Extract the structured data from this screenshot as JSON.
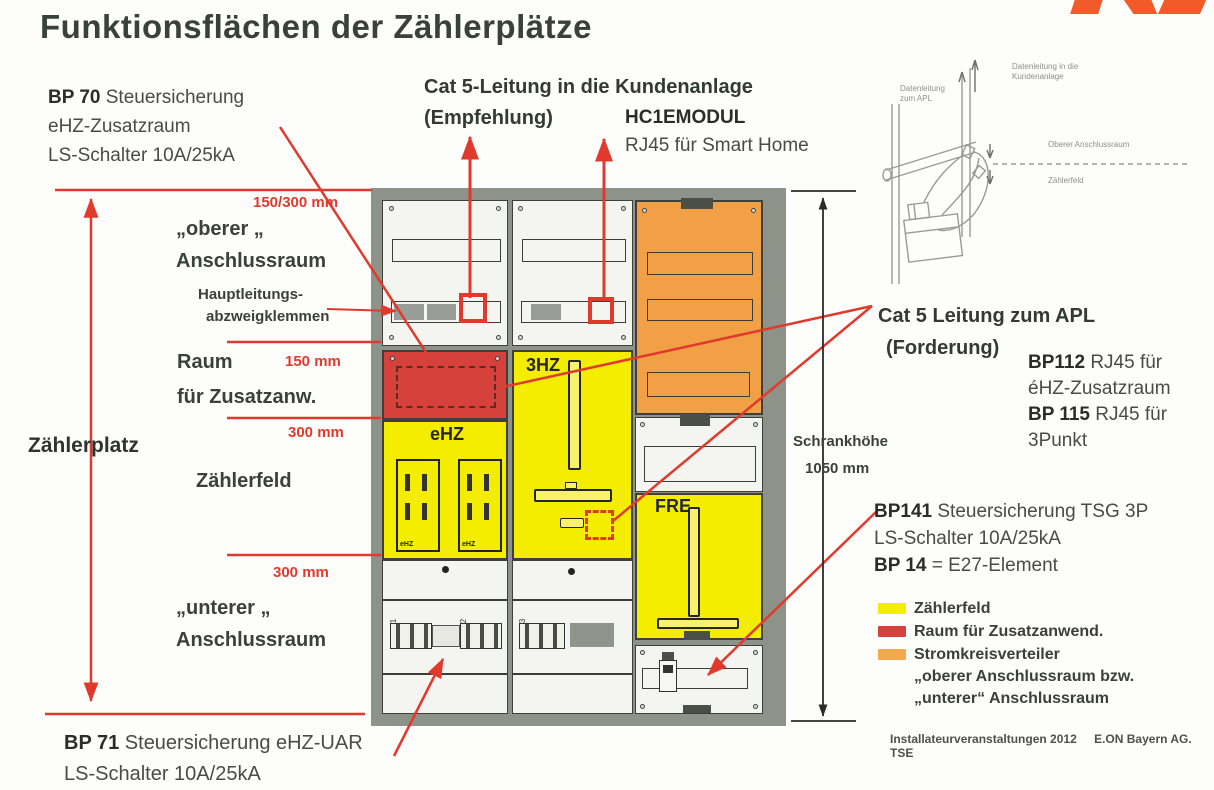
{
  "title": "Funktionsflächen der Zählerplätze",
  "colors": {
    "annotation_red": "#e03a2d",
    "panel_red": "#d6423b",
    "panel_yellow": "#f5ed00",
    "panel_orange": "#f1a046",
    "legend_orange": "#f5a94e",
    "frame_gray": "#8d9388",
    "logo_orange": "#f15a29"
  },
  "left": {
    "bp70": {
      "code": "BP 70",
      "text": " Steuersicherung",
      "line2": "eHZ-Zusatzraum",
      "line3": "LS-Schalter 10A/25kA"
    },
    "dim_top": "150/300 mm",
    "oberer1": "„oberer „",
    "oberer2": "Anschlussraum",
    "haupt1": "Hauptleitungs-",
    "haupt2": "abzweigklemmen",
    "raum1": "Raum",
    "dim_150": "150 mm",
    "raum2": "für Zusatzanw.",
    "dim_300a": "300 mm",
    "zaehlerplatz": "Zählerplatz",
    "zaehlerfeld": "Zählerfeld",
    "dim_300b": "300 mm",
    "unterer1": "„unterer „",
    "unterer2": "Anschlussraum",
    "bp71": {
      "code": "BP 71",
      "text": " Steuersicherung eHZ-UAR",
      "line2": "LS-Schalter 10A/25kA"
    }
  },
  "top": {
    "cat5_1": "Cat 5-Leitung in die Kundenanlage",
    "cat5_2": "(Empfehlung)",
    "hc1": "HC1EMODUL",
    "hc1_2": "RJ45 für Smart Home"
  },
  "right": {
    "cat5apl_1": "Cat 5 Leitung zum APL",
    "cat5apl_2": "(Forderung)",
    "bp112": {
      "code1": "BP112",
      "text1": " RJ45 für",
      "line2": "éHZ-Zusatzraum",
      "code2": "BP 115",
      "text2": " RJ45 für",
      "line3": "3Punkt"
    },
    "schrank1": "Schrankhöhe",
    "schrank2": "1050 mm",
    "bp141": {
      "code1": "BP141",
      "text1": " Steuersicherung TSG 3P",
      "line2": "LS-Schalter 10A/25kA",
      "code2": "BP 14",
      "text2": " = E27-Element"
    },
    "legend": {
      "item1": "Zählerfeld",
      "item2": "Raum für Zusatzanwend.",
      "item3": "Stromkreisverteiler",
      "extra1": "„oberer Anschlussraum bzw.",
      "extra2": "„unterer“ Anschlussraum"
    },
    "footer1": "Installateurveranstaltungen 2012",
    "footer2": "E.ON Bayern AG. TSE"
  },
  "cabinet": {
    "ehz": "eHZ",
    "hz3": "3HZ",
    "fre": "FRE",
    "meter": "eHZ",
    "f1": "F1",
    "f2": "F2",
    "f3": "F3"
  },
  "sketch": {
    "l1a": "Datenleitung",
    "l1b": "zum APL",
    "l2a": "Datenleitung in die",
    "l2b": "Kundenanlage",
    "l3": "Oberer Anschlussraum",
    "l4": "Zählerfeld"
  }
}
